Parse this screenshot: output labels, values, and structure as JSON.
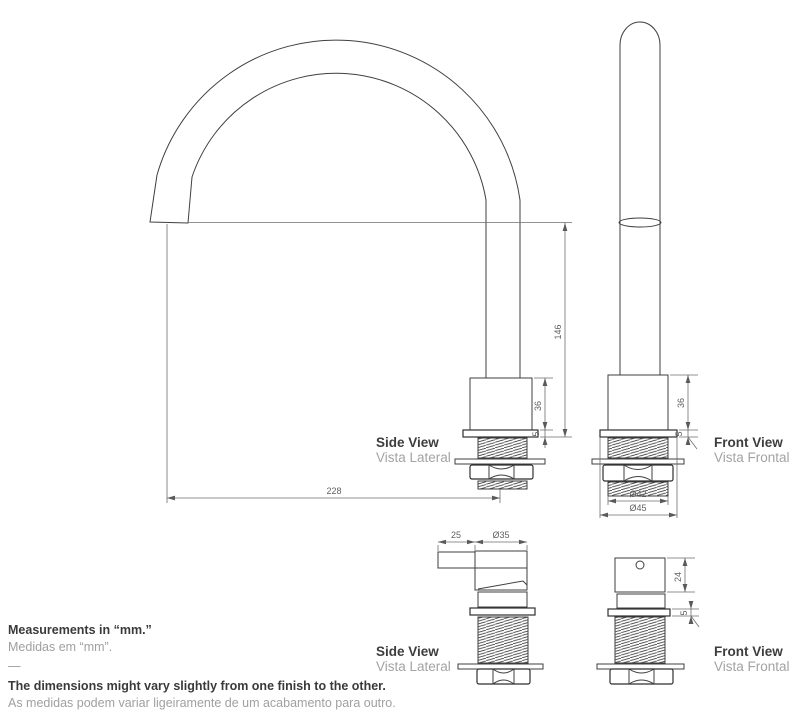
{
  "views": {
    "spout_side": {
      "title": "Side View",
      "subtitle": "Vista Lateral"
    },
    "spout_front": {
      "title": "Front View",
      "subtitle": "Vista Frontal"
    },
    "handle_side": {
      "title": "Side View",
      "subtitle": "Vista Lateral"
    },
    "handle_front": {
      "title": "Front View",
      "subtitle": "Vista Frontal"
    }
  },
  "dims": {
    "spout_outlet_height": "146",
    "spout_body_height_side": "36",
    "spout_flange_height_side": "5",
    "spout_reach": "228",
    "spout_body_height_front": "36",
    "spout_flange_height_front": "5",
    "spout_thread_diameter": "Ø42",
    "spout_flange_diameter": "Ø45",
    "handle_lever_length": "25",
    "handle_body_diameter": "Ø35",
    "handle_body_height": "24",
    "handle_flange_height": "5"
  },
  "notes": {
    "measurements_title": "Measurements in “mm.”",
    "measurements_subtitle": "Medidas em “mm”.",
    "separator": "—",
    "disclaimer_title": "The dimensions might vary slightly from one finish to the other.",
    "disclaimer_subtitle": "As medidas podem variar ligeiramente de um acabamento para outro."
  },
  "colors": {
    "line": "#3f3f3f",
    "dimension_line": "#6f6f6f",
    "text_dark": "#3d3d3d",
    "text_gray": "#a3a3a3"
  }
}
